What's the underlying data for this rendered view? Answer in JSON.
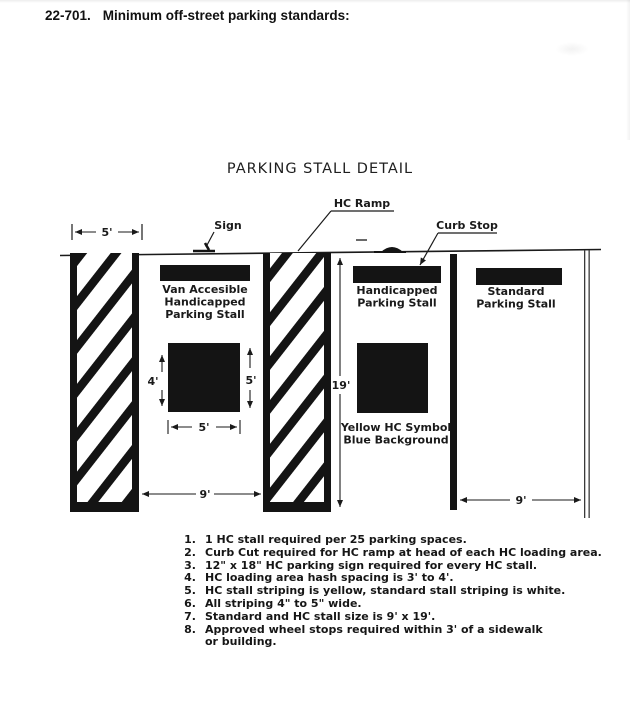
{
  "header": {
    "section": "22-701.",
    "title": "Minimum off-street parking standards:"
  },
  "diagram_title": "PARKING STALL DETAIL",
  "callouts": {
    "sign": "Sign",
    "hc_ramp": "HC Ramp",
    "curb_stop": "Curb Stop"
  },
  "dimensions": {
    "loading_area_width": "5'",
    "symbol_height": "4'",
    "symbol_side": "5'",
    "symbol_width": "5'",
    "stall_depth": "19'",
    "hc_stall_width": "9'",
    "standard_stall_width": "9'"
  },
  "stalls": {
    "van_accessible": {
      "lines": [
        "Van Accesible",
        "Handicapped",
        "Parking Stall"
      ]
    },
    "handicapped": {
      "lines": [
        "Handicapped",
        "Parking Stall"
      ]
    },
    "standard": {
      "lines": [
        "Standard",
        "Parking Stall"
      ]
    }
  },
  "hc_symbol_note": {
    "lines": [
      "Yellow HC Symbol",
      "Blue Background"
    ]
  },
  "notes": {
    "items": [
      {
        "num": "1.",
        "text": "1 HC stall required per 25 parking spaces."
      },
      {
        "num": "2.",
        "text": "Curb Cut required for HC ramp at head of each HC loading area."
      },
      {
        "num": "3.",
        "text": "12\" x 18\" HC parking sign required for every HC stall."
      },
      {
        "num": "4.",
        "text": "HC loading area hash spacing is 3' to 4'."
      },
      {
        "num": "5.",
        "text": "HC stall striping is yellow, standard stall striping is white."
      },
      {
        "num": "6.",
        "text": "All striping 4\" to 5\" wide."
      },
      {
        "num": "7.",
        "text": "Standard and HC stall size is 9' x 19'."
      },
      {
        "num": "8.",
        "text": "Approved wheel stops required within 3' of a sidewalk",
        "text2": "or building."
      }
    ]
  }
}
